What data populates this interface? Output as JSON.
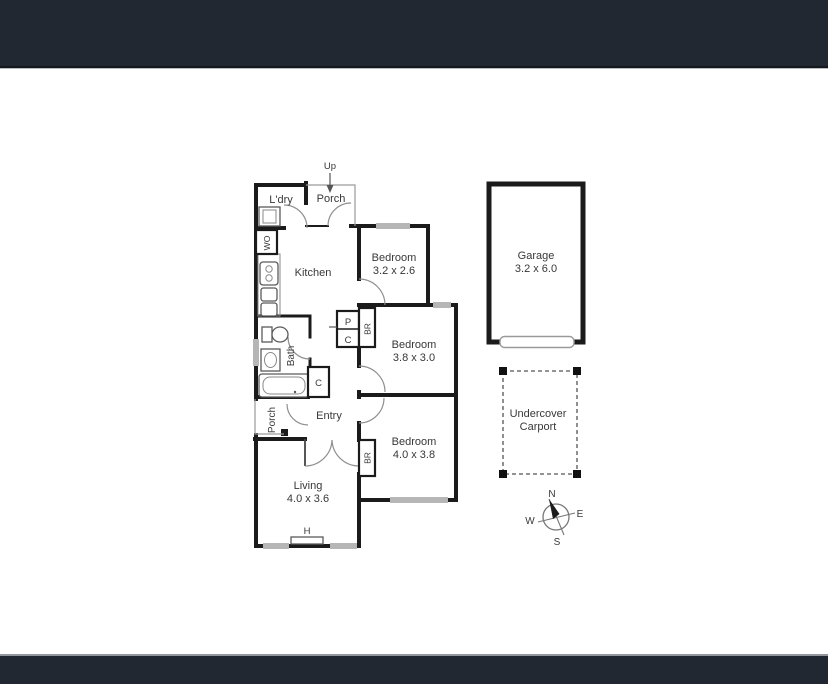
{
  "colors": {
    "frame_bar": "#222831",
    "wall": "#1b1b1b",
    "window_sill": "#b6b6b6",
    "door_arc": "#8f8f8f",
    "label_text": "#383838"
  },
  "plan": {
    "stairs_label": "Up",
    "laundry": {
      "label": "L'dry"
    },
    "porch_top": {
      "label": "Porch"
    },
    "kitchen": {
      "label": "Kitchen",
      "wall_oven": "WO"
    },
    "bedroom_1": {
      "label": "Bedroom",
      "dims": "3.2 x 2.6"
    },
    "bedroom_2": {
      "label": "Bedroom",
      "dims": "3.8 x 3.0",
      "robe": "BR"
    },
    "bedroom_3": {
      "label": "Bedroom",
      "dims": "4.0 x 3.8",
      "robe": "BR"
    },
    "bath": {
      "label": "Bath"
    },
    "pantry": {
      "top": "P",
      "bottom": "C"
    },
    "hall_cupboard": {
      "label": "C"
    },
    "entry": {
      "label": "Entry"
    },
    "porch_side": {
      "label": "Porch"
    },
    "living": {
      "label": "Living",
      "dims": "4.0 x 3.6",
      "heater": "H"
    },
    "garage": {
      "label": "Garage",
      "dims": "3.2 x 6.0"
    },
    "carport": {
      "line1": "Undercover",
      "line2": "Carport"
    },
    "compass": {
      "north": "N",
      "east": "E",
      "south": "S",
      "west": "W"
    }
  }
}
